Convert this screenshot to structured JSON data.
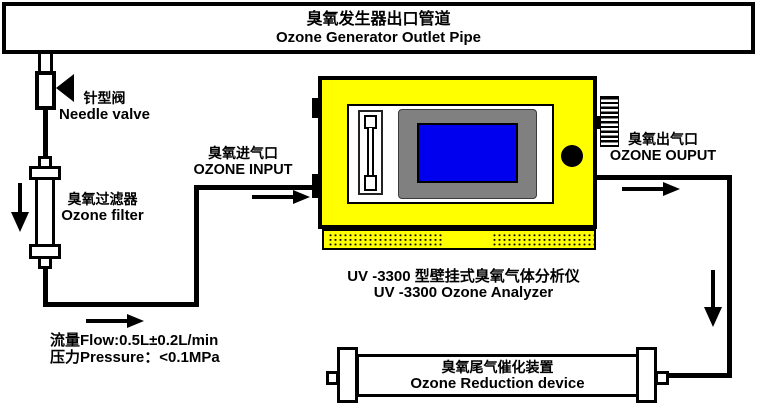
{
  "colors": {
    "background": "#ffffff",
    "line": "#000000",
    "device_yellow": "#ffff00",
    "screen_blue": "#0000ee",
    "bezel_gray": "#808080"
  },
  "top_pipe": {
    "label_zh": "臭氧发生器出口管道",
    "label_en": "Ozone Generator Outlet Pipe"
  },
  "needle_valve": {
    "label_zh": "针型阀",
    "label_en": "Needle valve"
  },
  "ozone_filter": {
    "label_zh": "臭氧过滤器",
    "label_en": "Ozone filter"
  },
  "ozone_input": {
    "label_zh": "臭氧进气口",
    "label_en": "OZONE INPUT"
  },
  "ozone_output": {
    "label_zh": "臭氧出气口",
    "label_en": "OZONE OUPUT"
  },
  "analyzer": {
    "caption_zh": "UV -3300 型壁挂式臭氧气体分析仪",
    "caption_en": "UV -3300 Ozone Analyzer"
  },
  "reduction_device": {
    "label_zh": "臭氧尾气催化装置",
    "label_en": "Ozone Reduction device"
  },
  "specs": {
    "flow": "流量Flow:0.5L±0.2L/min",
    "pressure": "压力Pressure：<0.1MPa"
  }
}
